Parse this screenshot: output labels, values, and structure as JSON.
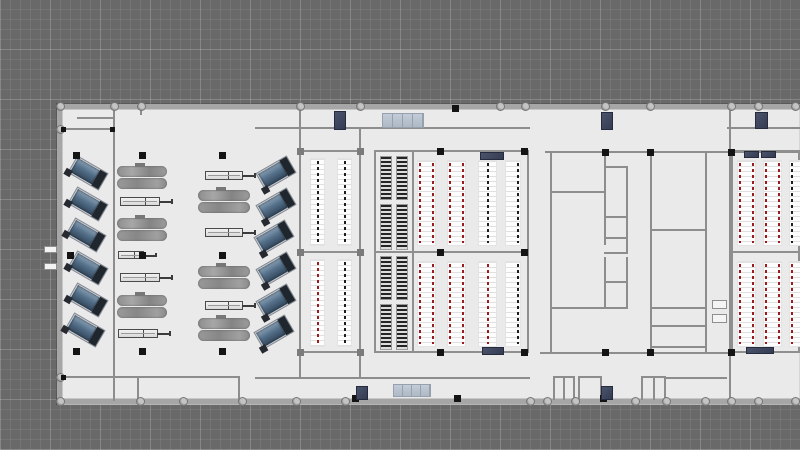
{
  "plan": {
    "canvas": {
      "w": 800,
      "h": 450
    },
    "palette": {
      "background": "#696969",
      "grid_minor": "#747474",
      "grid_major": "#7f7f7f",
      "floor": "#eaeaea",
      "wall_outer": "#a6a6a6",
      "wall_inner": "#8d8d8d",
      "rack_red": "#9c1b1e",
      "rack_black": "#1e1e1e",
      "accent_navy": "#3a4257",
      "accent_sky": "#b7c1ce",
      "machine_blue": "#54708a",
      "machine_gray": "#959595",
      "column_black": "#141414"
    },
    "floor": {
      "x": 57,
      "y": 104,
      "w": 743,
      "h": 301
    },
    "walls": [
      {
        "x": 57,
        "y": 104,
        "w": 743,
        "h": 5,
        "t": "o"
      },
      {
        "x": 57,
        "y": 399,
        "w": 743,
        "h": 5,
        "t": "o"
      },
      {
        "x": 57,
        "y": 104,
        "w": 5,
        "h": 300,
        "t": "o"
      },
      {
        "x": 113,
        "y": 107,
        "w": 2,
        "h": 294,
        "t": "i"
      },
      {
        "x": 57,
        "y": 128,
        "w": 57,
        "h": 2,
        "t": "i"
      },
      {
        "x": 140,
        "y": 106,
        "w": 2,
        "h": 9,
        "t": "i"
      },
      {
        "x": 57,
        "y": 376,
        "w": 182,
        "h": 2,
        "t": "i"
      },
      {
        "x": 137,
        "y": 377,
        "w": 2,
        "h": 24,
        "t": "i"
      },
      {
        "x": 238,
        "y": 376,
        "w": 2,
        "h": 25,
        "t": "i"
      },
      {
        "x": 255,
        "y": 127,
        "w": 275,
        "h": 2,
        "t": "i"
      },
      {
        "x": 255,
        "y": 377,
        "w": 275,
        "h": 2,
        "t": "i"
      },
      {
        "x": 545,
        "y": 151,
        "w": 255,
        "h": 2,
        "t": "i"
      },
      {
        "x": 727,
        "y": 127,
        "w": 73,
        "h": 2,
        "t": "i"
      },
      {
        "x": 729,
        "y": 106,
        "w": 2,
        "h": 296,
        "t": "i"
      },
      {
        "x": 299,
        "y": 106,
        "w": 2,
        "h": 44,
        "t": "i"
      },
      {
        "x": 299,
        "y": 352,
        "w": 2,
        "h": 26,
        "t": "i"
      },
      {
        "x": 359,
        "y": 128,
        "w": 2,
        "h": 22,
        "t": "i"
      },
      {
        "x": 359,
        "y": 352,
        "w": 2,
        "h": 26,
        "t": "i"
      },
      {
        "x": 550,
        "y": 152,
        "w": 2,
        "h": 200,
        "t": "i"
      },
      {
        "x": 550,
        "y": 191,
        "w": 56,
        "h": 2,
        "t": "i"
      },
      {
        "x": 604,
        "y": 152,
        "w": 2,
        "h": 93,
        "t": "i"
      },
      {
        "x": 604,
        "y": 166,
        "w": 24,
        "h": 2,
        "t": "i"
      },
      {
        "x": 626,
        "y": 166,
        "w": 2,
        "h": 88,
        "t": "i"
      },
      {
        "x": 604,
        "y": 216,
        "w": 24,
        "h": 2,
        "t": "i"
      },
      {
        "x": 604,
        "y": 237,
        "w": 24,
        "h": 2,
        "t": "i"
      },
      {
        "x": 604,
        "y": 252,
        "w": 24,
        "h": 2,
        "t": "i"
      },
      {
        "x": 604,
        "y": 257,
        "w": 2,
        "h": 51,
        "t": "i"
      },
      {
        "x": 626,
        "y": 257,
        "w": 2,
        "h": 51,
        "t": "i"
      },
      {
        "x": 604,
        "y": 281,
        "w": 24,
        "h": 2,
        "t": "i"
      },
      {
        "x": 550,
        "y": 307,
        "w": 78,
        "h": 2,
        "t": "i"
      },
      {
        "x": 650,
        "y": 152,
        "w": 2,
        "h": 200,
        "t": "i"
      },
      {
        "x": 705,
        "y": 152,
        "w": 2,
        "h": 200,
        "t": "i"
      },
      {
        "x": 650,
        "y": 229,
        "w": 57,
        "h": 2,
        "t": "i"
      },
      {
        "x": 650,
        "y": 307,
        "w": 57,
        "h": 2,
        "t": "i"
      },
      {
        "x": 650,
        "y": 325,
        "w": 57,
        "h": 2,
        "t": "i"
      },
      {
        "x": 650,
        "y": 346,
        "w": 57,
        "h": 2,
        "t": "i"
      },
      {
        "x": 540,
        "y": 352,
        "w": 190,
        "h": 2,
        "t": "i"
      },
      {
        "x": 553,
        "y": 376,
        "w": 22,
        "h": 2,
        "t": "i"
      },
      {
        "x": 553,
        "y": 376,
        "w": 2,
        "h": 24,
        "t": "i"
      },
      {
        "x": 563,
        "y": 376,
        "w": 2,
        "h": 24,
        "t": "i"
      },
      {
        "x": 573,
        "y": 376,
        "w": 2,
        "h": 24,
        "t": "i"
      },
      {
        "x": 578,
        "y": 376,
        "w": 24,
        "h": 2,
        "t": "i"
      },
      {
        "x": 578,
        "y": 376,
        "w": 2,
        "h": 24,
        "t": "i"
      },
      {
        "x": 600,
        "y": 376,
        "w": 2,
        "h": 24,
        "t": "i"
      },
      {
        "x": 641,
        "y": 376,
        "w": 25,
        "h": 2,
        "t": "i"
      },
      {
        "x": 641,
        "y": 376,
        "w": 2,
        "h": 24,
        "t": "i"
      },
      {
        "x": 653,
        "y": 376,
        "w": 2,
        "h": 24,
        "t": "i"
      },
      {
        "x": 664,
        "y": 376,
        "w": 2,
        "h": 24,
        "t": "i"
      },
      {
        "x": 665,
        "y": 377,
        "w": 62,
        "h": 2,
        "t": "i"
      }
    ],
    "desk_lines": [
      {
        "x": 77,
        "y": 117,
        "w": 37,
        "h": 2
      }
    ],
    "round_columns": [
      {
        "x": 60,
        "y": 106
      },
      {
        "x": 114,
        "y": 106
      },
      {
        "x": 141,
        "y": 106
      },
      {
        "x": 300,
        "y": 106
      },
      {
        "x": 360,
        "y": 106
      },
      {
        "x": 500,
        "y": 106
      },
      {
        "x": 525,
        "y": 106
      },
      {
        "x": 605,
        "y": 106
      },
      {
        "x": 650,
        "y": 106
      },
      {
        "x": 731,
        "y": 106
      },
      {
        "x": 758,
        "y": 106
      },
      {
        "x": 795,
        "y": 106
      },
      {
        "x": 60,
        "y": 129
      },
      {
        "x": 60,
        "y": 377
      },
      {
        "x": 60,
        "y": 401
      },
      {
        "x": 140,
        "y": 401
      },
      {
        "x": 183,
        "y": 401
      },
      {
        "x": 242,
        "y": 401
      },
      {
        "x": 296,
        "y": 401
      },
      {
        "x": 345,
        "y": 401
      },
      {
        "x": 530,
        "y": 401
      },
      {
        "x": 547,
        "y": 401
      },
      {
        "x": 575,
        "y": 401
      },
      {
        "x": 635,
        "y": 401
      },
      {
        "x": 666,
        "y": 401
      },
      {
        "x": 705,
        "y": 401
      },
      {
        "x": 731,
        "y": 401
      },
      {
        "x": 758,
        "y": 401
      },
      {
        "x": 795,
        "y": 401
      }
    ],
    "square_columns": [
      {
        "x": 76,
        "y": 155
      },
      {
        "x": 142,
        "y": 155
      },
      {
        "x": 222,
        "y": 155
      },
      {
        "x": 70,
        "y": 255
      },
      {
        "x": 142,
        "y": 255
      },
      {
        "x": 222,
        "y": 255
      },
      {
        "x": 76,
        "y": 351
      },
      {
        "x": 142,
        "y": 351
      },
      {
        "x": 222,
        "y": 351
      },
      {
        "x": 455,
        "y": 108
      },
      {
        "x": 355,
        "y": 398
      },
      {
        "x": 457,
        "y": 398
      },
      {
        "x": 603,
        "y": 398
      },
      {
        "x": 440,
        "y": 151
      },
      {
        "x": 524,
        "y": 151
      },
      {
        "x": 440,
        "y": 252
      },
      {
        "x": 524,
        "y": 252
      },
      {
        "x": 440,
        "y": 352
      },
      {
        "x": 524,
        "y": 352
      },
      {
        "x": 605,
        "y": 152
      },
      {
        "x": 650,
        "y": 152
      },
      {
        "x": 731,
        "y": 152
      },
      {
        "x": 605,
        "y": 352
      },
      {
        "x": 650,
        "y": 352
      },
      {
        "x": 731,
        "y": 352
      },
      {
        "x": 63,
        "y": 129,
        "s": 5
      },
      {
        "x": 112,
        "y": 129,
        "s": 5
      },
      {
        "x": 63,
        "y": 377,
        "s": 5
      },
      {
        "x": 300,
        "y": 151,
        "s": 7,
        "c": "gray"
      },
      {
        "x": 360,
        "y": 151,
        "s": 7,
        "c": "gray"
      },
      {
        "x": 300,
        "y": 252,
        "s": 7,
        "c": "gray"
      },
      {
        "x": 360,
        "y": 252,
        "s": 7,
        "c": "gray"
      },
      {
        "x": 300,
        "y": 352,
        "s": 7,
        "c": "gray"
      },
      {
        "x": 360,
        "y": 352,
        "s": 7,
        "c": "gray"
      }
    ],
    "frames": [
      {
        "x": 299,
        "y": 150,
        "w": 62,
        "h": 103
      },
      {
        "x": 299,
        "y": 251,
        "w": 62,
        "h": 102
      },
      {
        "x": 374,
        "y": 150,
        "w": 40,
        "h": 103
      },
      {
        "x": 374,
        "y": 251,
        "w": 40,
        "h": 102
      },
      {
        "x": 412,
        "y": 150,
        "w": 117,
        "h": 103
      },
      {
        "x": 412,
        "y": 251,
        "w": 117,
        "h": 102
      },
      {
        "x": 731,
        "y": 150,
        "w": 69,
        "h": 103
      },
      {
        "x": 731,
        "y": 251,
        "w": 69,
        "h": 102
      }
    ],
    "racks": {
      "white": [
        {
          "x": 310,
          "y": 158,
          "w": 15,
          "h": 88,
          "lines": [
            {
              "pos": "center",
              "color": "black"
            }
          ]
        },
        {
          "x": 337,
          "y": 158,
          "w": 15,
          "h": 88,
          "lines": [
            {
              "pos": "center",
              "color": "black"
            }
          ]
        },
        {
          "x": 310,
          "y": 259,
          "w": 15,
          "h": 88,
          "lines": [
            {
              "pos": "center",
              "color": "red"
            }
          ]
        },
        {
          "x": 337,
          "y": 259,
          "w": 15,
          "h": 88,
          "lines": [
            {
              "pos": "center",
              "color": "black"
            }
          ]
        },
        {
          "x": 417,
          "y": 160,
          "w": 19,
          "h": 86,
          "lines": [
            {
              "pos": "left",
              "color": "red"
            },
            {
              "pos": "right",
              "color": "red"
            }
          ]
        },
        {
          "x": 447,
          "y": 160,
          "w": 19,
          "h": 86,
          "lines": [
            {
              "pos": "left",
              "color": "red"
            },
            {
              "pos": "right",
              "color": "red"
            }
          ]
        },
        {
          "x": 478,
          "y": 160,
          "w": 19,
          "h": 86,
          "lines": [
            {
              "pos": "center",
              "color": "black"
            }
          ]
        },
        {
          "x": 505,
          "y": 160,
          "w": 16,
          "h": 86,
          "lines": [
            {
              "pos": "right",
              "color": "black"
            }
          ]
        },
        {
          "x": 417,
          "y": 261,
          "w": 19,
          "h": 86,
          "lines": [
            {
              "pos": "left",
              "color": "red"
            },
            {
              "pos": "right",
              "color": "red"
            }
          ]
        },
        {
          "x": 447,
          "y": 261,
          "w": 19,
          "h": 86,
          "lines": [
            {
              "pos": "left",
              "color": "red"
            },
            {
              "pos": "right",
              "color": "red"
            }
          ]
        },
        {
          "x": 478,
          "y": 261,
          "w": 19,
          "h": 86,
          "lines": [
            {
              "pos": "center",
              "color": "red"
            }
          ]
        },
        {
          "x": 505,
          "y": 261,
          "w": 16,
          "h": 86,
          "lines": [
            {
              "pos": "right",
              "color": "black"
            }
          ]
        },
        {
          "x": 737,
          "y": 160,
          "w": 19,
          "h": 86,
          "lines": [
            {
              "pos": "left",
              "color": "red"
            },
            {
              "pos": "right",
              "color": "red"
            }
          ]
        },
        {
          "x": 763,
          "y": 160,
          "w": 19,
          "h": 86,
          "lines": [
            {
              "pos": "left",
              "color": "red"
            },
            {
              "pos": "right",
              "color": "red"
            }
          ]
        },
        {
          "x": 789,
          "y": 160,
          "w": 14,
          "h": 86,
          "lines": [
            {
              "pos": "left",
              "color": "black"
            }
          ]
        },
        {
          "x": 737,
          "y": 261,
          "w": 19,
          "h": 86,
          "lines": [
            {
              "pos": "left",
              "color": "red"
            },
            {
              "pos": "right",
              "color": "red"
            }
          ]
        },
        {
          "x": 763,
          "y": 261,
          "w": 19,
          "h": 86,
          "lines": [
            {
              "pos": "left",
              "color": "red"
            },
            {
              "pos": "right",
              "color": "red"
            }
          ]
        },
        {
          "x": 789,
          "y": 261,
          "w": 14,
          "h": 86,
          "lines": [
            {
              "pos": "left",
              "color": "red"
            }
          ]
        }
      ],
      "dense": [
        {
          "x": 380,
          "y": 156,
          "w": 12,
          "h": 44
        },
        {
          "x": 396,
          "y": 156,
          "w": 12,
          "h": 44
        },
        {
          "x": 380,
          "y": 204,
          "w": 12,
          "h": 46
        },
        {
          "x": 396,
          "y": 204,
          "w": 12,
          "h": 46
        },
        {
          "x": 380,
          "y": 256,
          "w": 12,
          "h": 44
        },
        {
          "x": 396,
          "y": 256,
          "w": 12,
          "h": 44
        },
        {
          "x": 380,
          "y": 304,
          "w": 12,
          "h": 46
        },
        {
          "x": 396,
          "y": 304,
          "w": 12,
          "h": 46
        }
      ]
    },
    "machines": {
      "angled": [
        {
          "x": 70,
          "y": 163,
          "r": 30
        },
        {
          "x": 70,
          "y": 194,
          "r": 30
        },
        {
          "x": 68,
          "y": 225,
          "r": 30
        },
        {
          "x": 70,
          "y": 258,
          "r": 30
        },
        {
          "x": 70,
          "y": 290,
          "r": 30
        },
        {
          "x": 67,
          "y": 320,
          "r": 30
        },
        {
          "x": 258,
          "y": 163,
          "r": -30
        },
        {
          "x": 258,
          "y": 195,
          "r": -30
        },
        {
          "x": 256,
          "y": 227,
          "r": -30
        },
        {
          "x": 258,
          "y": 259,
          "r": -30
        },
        {
          "x": 258,
          "y": 291,
          "r": -30
        },
        {
          "x": 256,
          "y": 322,
          "r": -30
        }
      ],
      "lathe": [
        {
          "x": 117,
          "y": 166,
          "w": 50,
          "h": 23
        },
        {
          "x": 117,
          "y": 218,
          "w": 50,
          "h": 23
        },
        {
          "x": 117,
          "y": 295,
          "w": 50,
          "h": 23
        },
        {
          "x": 198,
          "y": 190,
          "w": 52,
          "h": 23
        },
        {
          "x": 198,
          "y": 266,
          "w": 52,
          "h": 23
        },
        {
          "x": 198,
          "y": 318,
          "w": 52,
          "h": 23
        }
      ],
      "bench": [
        {
          "x": 120,
          "y": 197,
          "w": 40,
          "h": 9
        },
        {
          "x": 118,
          "y": 251,
          "w": 26,
          "h": 8
        },
        {
          "x": 120,
          "y": 273,
          "w": 40,
          "h": 9
        },
        {
          "x": 118,
          "y": 329,
          "w": 40,
          "h": 9
        },
        {
          "x": 205,
          "y": 171,
          "w": 38,
          "h": 9
        },
        {
          "x": 205,
          "y": 228,
          "w": 38,
          "h": 9
        },
        {
          "x": 205,
          "y": 301,
          "w": 38,
          "h": 9
        }
      ]
    },
    "accents": [
      {
        "x": 334,
        "y": 111,
        "w": 12,
        "h": 19,
        "k": "navy"
      },
      {
        "x": 601,
        "y": 112,
        "w": 12,
        "h": 18,
        "k": "navy"
      },
      {
        "x": 755,
        "y": 112,
        "w": 13,
        "h": 17,
        "k": "navy"
      },
      {
        "x": 356,
        "y": 386,
        "w": 12,
        "h": 14,
        "k": "navy"
      },
      {
        "x": 601,
        "y": 386,
        "w": 12,
        "h": 14,
        "k": "navy"
      },
      {
        "x": 480,
        "y": 152,
        "w": 24,
        "h": 8,
        "k": "navy"
      },
      {
        "x": 482,
        "y": 347,
        "w": 22,
        "h": 8,
        "k": "navy"
      },
      {
        "x": 744,
        "y": 151,
        "w": 15,
        "h": 7,
        "k": "navy"
      },
      {
        "x": 761,
        "y": 151,
        "w": 15,
        "h": 7,
        "k": "navy"
      },
      {
        "x": 746,
        "y": 347,
        "w": 28,
        "h": 7,
        "k": "navy"
      },
      {
        "x": 382,
        "y": 113,
        "w": 42,
        "h": 15,
        "k": "sky"
      },
      {
        "x": 393,
        "y": 384,
        "w": 38,
        "h": 13,
        "k": "sky"
      },
      {
        "x": 44,
        "y": 246,
        "w": 13,
        "h": 7,
        "k": "door"
      },
      {
        "x": 44,
        "y": 263,
        "w": 13,
        "h": 7,
        "k": "door"
      },
      {
        "x": 712,
        "y": 300,
        "w": 15,
        "h": 9,
        "k": "door"
      },
      {
        "x": 712,
        "y": 314,
        "w": 15,
        "h": 9,
        "k": "door"
      }
    ]
  }
}
